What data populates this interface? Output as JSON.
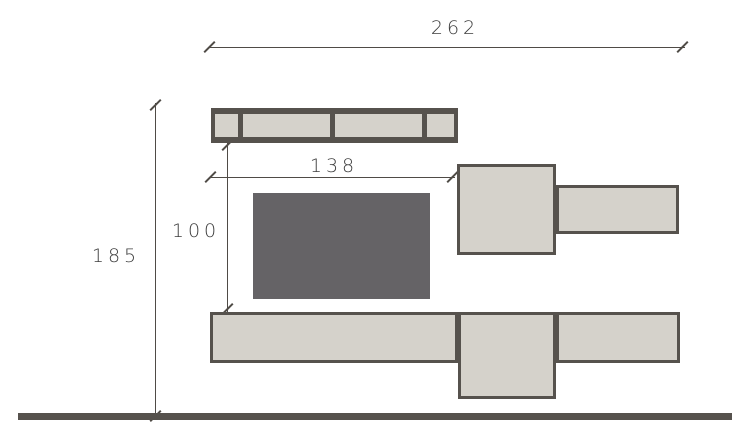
{
  "dimensions": {
    "overall_width": "262",
    "overall_height": "185",
    "left_section_width": "138",
    "middle_gap_height": "100"
  },
  "colors": {
    "background": "#ffffff",
    "block_fill": "#d5d2cb",
    "block_border": "#56524d",
    "tv_fill": "#656366",
    "floor": "#56524d",
    "dim_line": "#4f4b46",
    "dim_text": "#3d3d3d"
  }
}
